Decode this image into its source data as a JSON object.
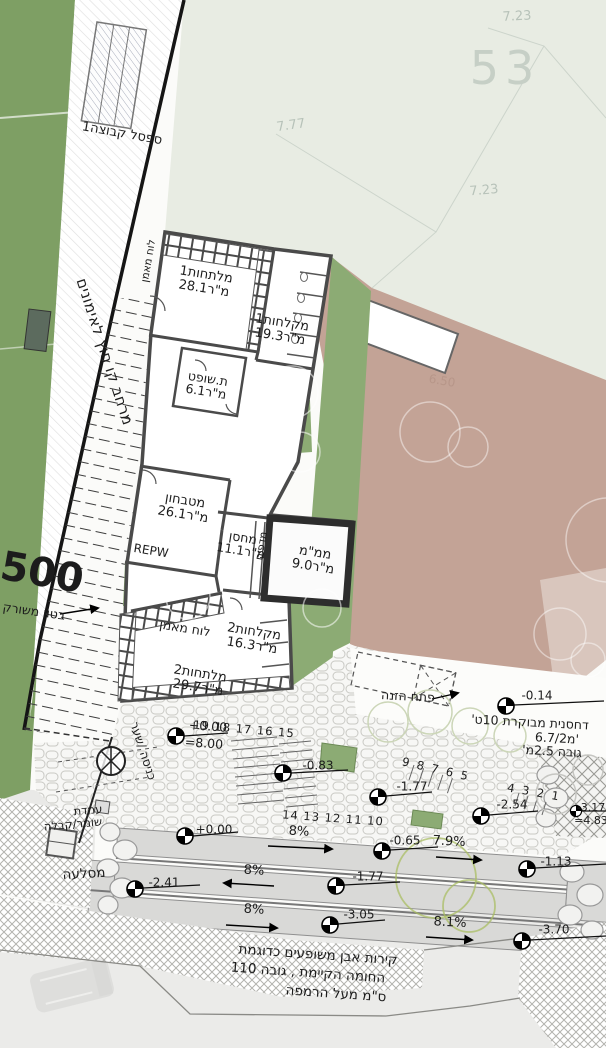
{
  "plan": {
    "parcel": {
      "num_top": "7.23",
      "big": "53",
      "num_left": "7.77",
      "num_mid": "7.23",
      "faint_elev": "6.50"
    },
    "field": {
      "bench": "ספסל קבוצה1",
      "strip": "מרחב קו חוץ לאימונים",
      "road": "500",
      "concrete": "בטון משורק"
    },
    "rooms": {
      "changing1": {
        "name": "מלתחות1",
        "area": "28.1מ\"ר"
      },
      "showers1": {
        "name": "מקלחות1",
        "area": "19.3מ\"ר"
      },
      "referee": {
        "name": "ת.שופט",
        "area": "6.1מ\"ר"
      },
      "kitchen": {
        "name": "מטבחון",
        "area": "26.1מ\"ר"
      },
      "storage": {
        "name": "מחסן",
        "area": "11.1מ\"ר"
      },
      "shelter": {
        "name": "ממ\"מ",
        "area": "9.0מ\"ר"
      },
      "showers2": {
        "name": "מקלחות2",
        "area": "16.3מ\"ר"
      },
      "changing2": {
        "name": "מלתחות2",
        "area": "29.7מ\"ר"
      }
    },
    "fixtures": {
      "coach_board_v": "לוח מאמן",
      "coach_board_h": "לוח מאמן",
      "shelves": "מדפים",
      "equip": "REPW"
    },
    "compactor": {
      "feed": "פתח הזנה",
      "l1": "דחסנית מבוקרת 10ט'",
      "l2": "6.7/2מ'",
      "l3": "גובה 2.5מ'",
      "elev": "-0.14"
    },
    "entrance": {
      "gate": "כניסה /שער",
      "guard1": "עמדת",
      "guard2": "שומר/קבלה",
      "rockery": "מסלעה",
      "elev": "+0.00",
      "elev_eq": "=8.00"
    },
    "stairs": {
      "run1": "19 18 17 16 15",
      "run2": "14 13 12 11 10",
      "run3": "9 8 7 6 5",
      "run4": "4 3 2 1"
    },
    "levels": {
      "p083": "-0.83",
      "p177": "-1.77",
      "p254": "-2.54",
      "p317": "-3.17",
      "p483": "=4.83",
      "r000": "+0.00",
      "r065": "-0.65",
      "r113": "-1.13",
      "r241": "-2.41",
      "r177": "-1.77",
      "r305": "-3.05",
      "r370": "-3.70"
    },
    "slopes": {
      "a": "8%",
      "b": "7.9%",
      "c": "8%",
      "d": "8%",
      "e": "8.1%"
    },
    "wall_note": {
      "l1": "קירות אבן משופעים כדוגמת",
      "l2": "החומה הקיימת , גובה 110",
      "l3": "ס\"מ מעל הרמפה"
    },
    "colors": {
      "field_green": "#7e9f64",
      "courtyard_green": "#8cab74",
      "parcel_pale": "#e8ece3",
      "terrain_brown": "#c3a396",
      "ramp_gray": "#d9d9d7",
      "wall_dark": "#4a4a4a"
    }
  }
}
